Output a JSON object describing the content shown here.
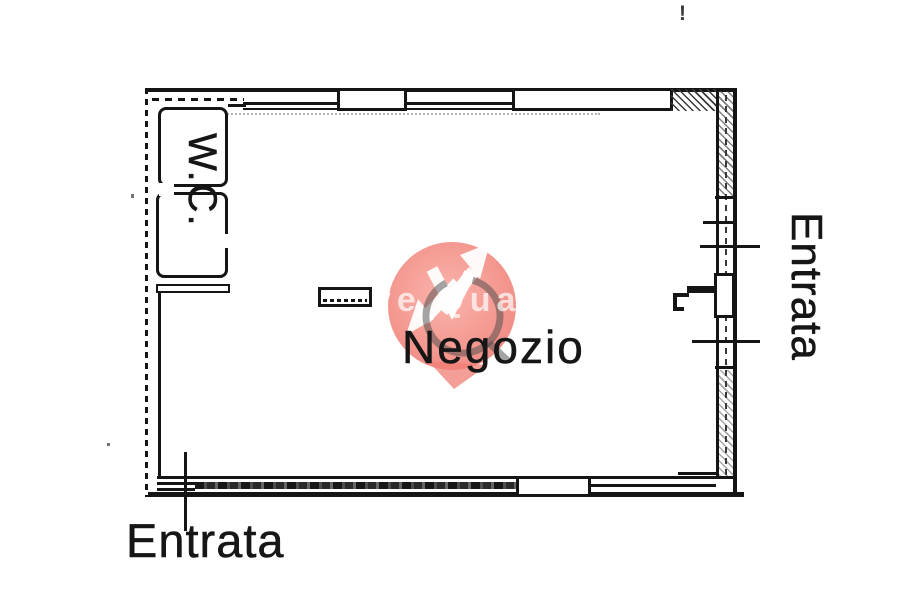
{
  "title": "Floor plan of a shop",
  "plan": {
    "room_label": "Negozio",
    "wc_label": "W.C.",
    "entrance_right_label": "Entrata",
    "entrance_bottom_label": "Entrata",
    "stray_mark": "!"
  },
  "watermark": {
    "text_fragment": "ve Quat",
    "circle_color": "#ef7d74",
    "circle_color_light": "#f9aca3",
    "arrow_color": "#ffffff",
    "ring_color": "#4a4a4a",
    "text_color": "#ffffff"
  },
  "colors": {
    "ink": "#151515",
    "background": "#ffffff"
  }
}
